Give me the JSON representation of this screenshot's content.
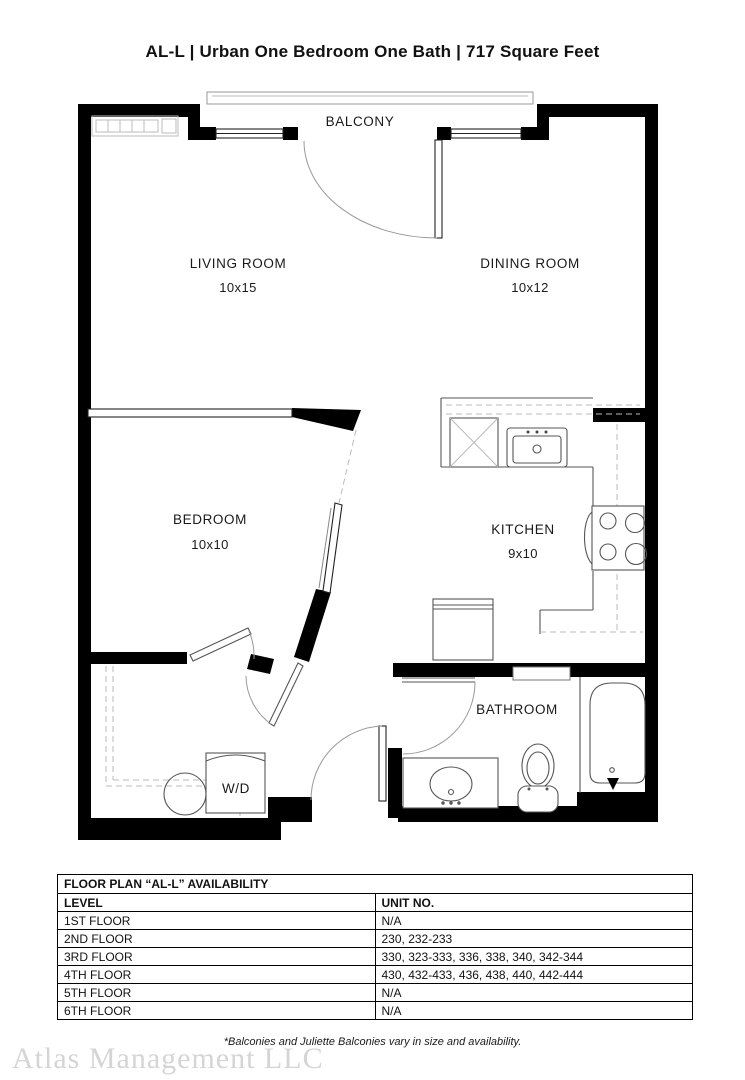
{
  "page": {
    "title": "AL-L | Urban One Bedroom One Bath | 717 Square Feet"
  },
  "floor_plan": {
    "rooms": {
      "balcony": {
        "label": "BALCONY"
      },
      "living_room": {
        "label": "LIVING ROOM",
        "dimensions": "10x15"
      },
      "dining_room": {
        "label": "DINING ROOM",
        "dimensions": "10x12"
      },
      "bedroom": {
        "label": "BEDROOM",
        "dimensions": "10x10"
      },
      "kitchen": {
        "label": "KITCHEN",
        "dimensions": "9x10"
      },
      "bathroom": {
        "label": "BATHROOM"
      },
      "laundry": {
        "label": "W/D"
      }
    }
  },
  "availability_table": {
    "title": "FLOOR PLAN “AL-L” AVAILABILITY",
    "columns": {
      "level": "LEVEL",
      "units": "UNIT NO."
    },
    "rows": [
      {
        "level": "1ST FLOOR",
        "units": "N/A"
      },
      {
        "level": "2ND FLOOR",
        "units": "230, 232-233"
      },
      {
        "level": "3RD FLOOR",
        "units": "330, 323-333, 336, 338, 340, 342-344"
      },
      {
        "level": "4TH FLOOR",
        "units": "430, 432-433, 436, 438, 440, 442-444"
      },
      {
        "level": "5TH FLOOR",
        "units": "N/A"
      },
      {
        "level": "6TH FLOOR",
        "units": "N/A"
      }
    ]
  },
  "footnote": "*Balconies and Juliette Balconies vary in size and availability.",
  "watermark": "Atlas Management LLC",
  "colors": {
    "wall": "#000000",
    "fixture_line": "#555555",
    "light_line": "#bbbbbb",
    "watermark": "#d5d5d5"
  }
}
